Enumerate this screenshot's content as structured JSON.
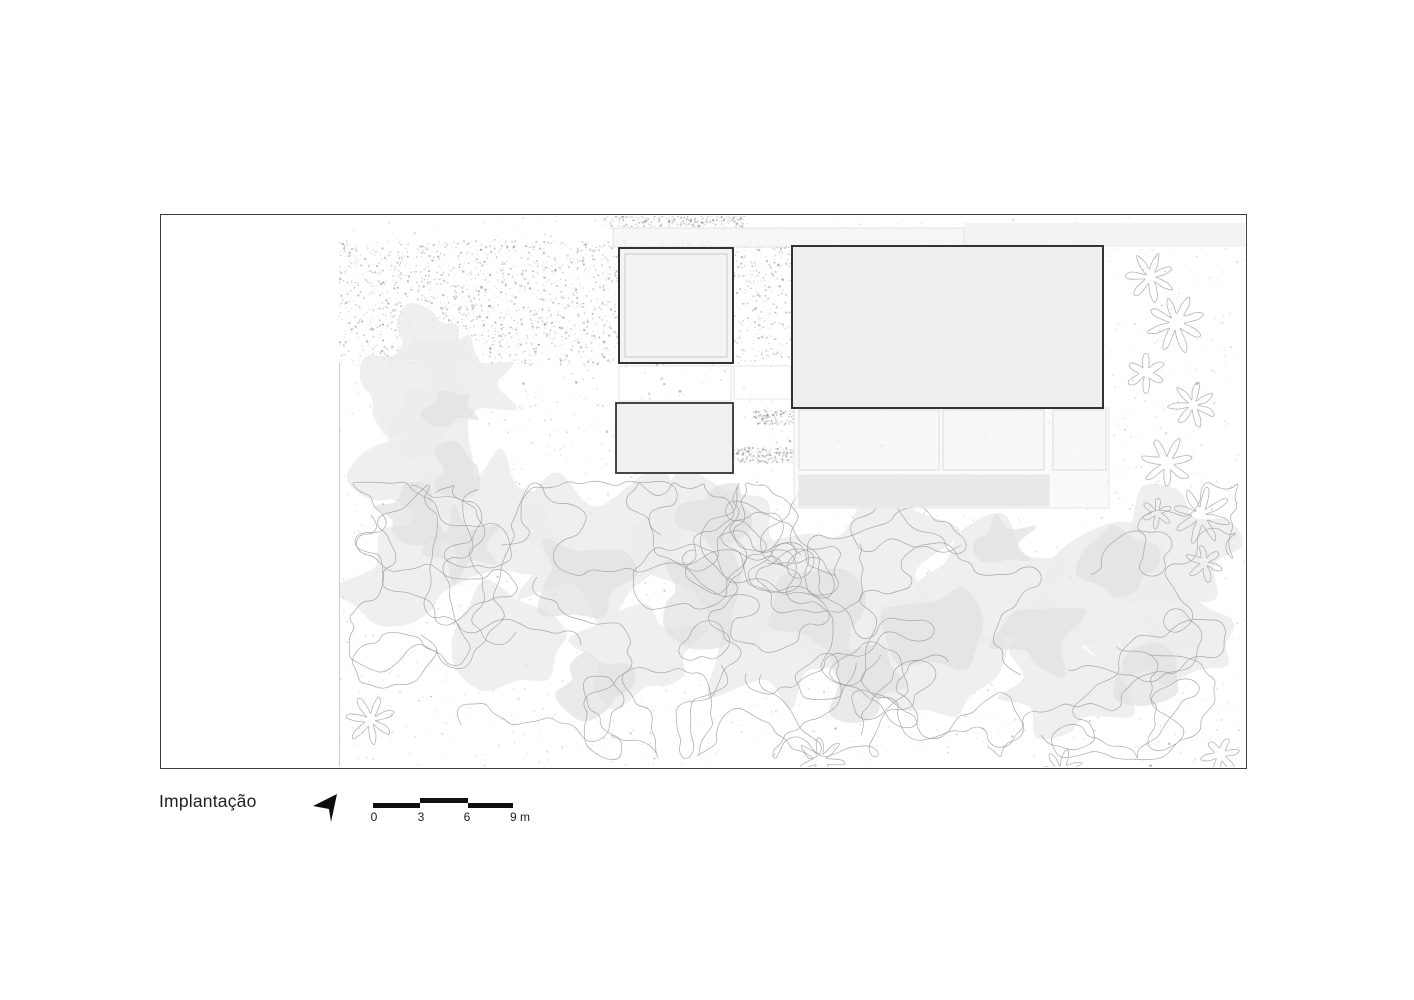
{
  "drawing": {
    "title": "Implantação",
    "scale_bar": {
      "labels": [
        "0",
        "3",
        "6",
        "9 m"
      ]
    },
    "icons": {
      "north_arrow": "north-arrow"
    }
  },
  "colors": {
    "ink": "#1f1f1f",
    "frame": "#3f3f3f",
    "scale_bar": "#101010",
    "building_stroke": "#333333",
    "building_fill": "#f2f2f2",
    "canopy_light": "#ececec",
    "canopy_mid": "#e1e1e1",
    "contour": "#9a9a9a",
    "shrub": "#a8a8a8",
    "speckle": "#8a8a8a",
    "gravel": "#767676",
    "paving_stroke": "#dddddd"
  }
}
